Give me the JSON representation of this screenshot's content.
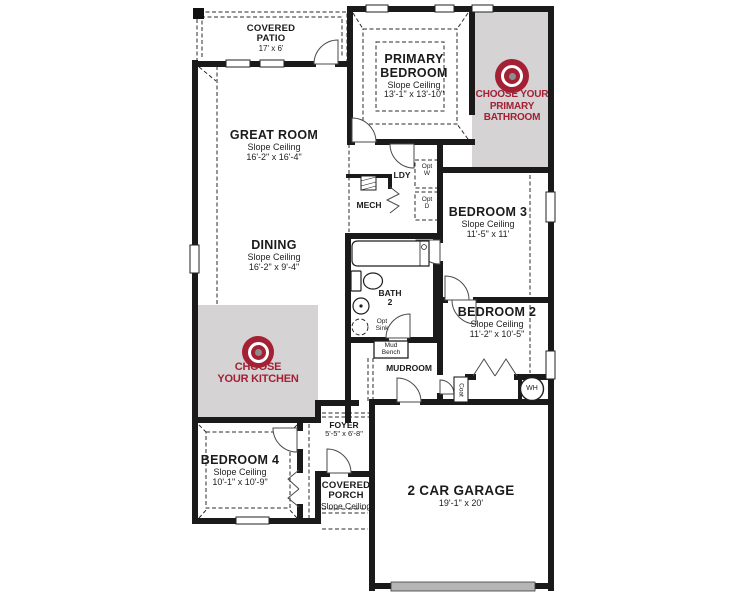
{
  "title": "Floor Plan",
  "colors": {
    "accent_red": "#A32035",
    "room_fill_gray": "#D5D3D3",
    "wall_black": "#1A1A1A",
    "garage_door_gray": "#B5B5B5"
  },
  "rooms": {
    "covered_patio": {
      "line1": "COVERED",
      "line2": "PATIO",
      "dims": "17' x 6'"
    },
    "primary_bedroom": {
      "line1": "PRIMARY",
      "line2": "BEDROOM",
      "sub": "Slope Ceiling",
      "dims": "13'-1\" x 13'-10\""
    },
    "great_room": {
      "line1": "GREAT ROOM",
      "sub": "Slope Ceiling",
      "dims": "16'-2\" x 16'-4\""
    },
    "dining": {
      "line1": "DINING",
      "sub": "Slope Ceiling",
      "dims": "16'-2\" x 9'-4\""
    },
    "bedroom_3": {
      "line1": "BEDROOM 3",
      "sub": "Slope Ceiling",
      "dims": "11'-5\" x 11'"
    },
    "bedroom_2": {
      "line1": "BEDROOM 2",
      "sub": "Slope Ceiling",
      "dims": "11'-2\" x 10'-5\""
    },
    "bedroom_4": {
      "line1": "BEDROOM 4",
      "sub": "Slope Ceiling",
      "dims": "10'-1\" x 10'-9\""
    },
    "foyer": {
      "line1": "FOYER",
      "dims": "5'-5\" x 6'-8\""
    },
    "covered_porch": {
      "line1": "COVERED",
      "line2": "PORCH",
      "sub": "Slope Ceiling"
    },
    "garage": {
      "line1": "2 CAR GARAGE",
      "dims": "19'-1\" x 20'"
    },
    "mech": {
      "line1": "MECH"
    },
    "laundry": {
      "line1": "LDY"
    },
    "bath_2": {
      "line1": "BATH",
      "line2": "2"
    },
    "mudroom": {
      "line1": "MUDROOM"
    }
  },
  "fixtures": {
    "opt_washer": {
      "line1": "Opt",
      "line2": "W"
    },
    "opt_dryer": {
      "line1": "Opt",
      "line2": "D"
    },
    "opt_sink": {
      "line1": "Opt",
      "line2": "Sink"
    },
    "mud_bench": {
      "line1": "Mud",
      "line2": "Bench"
    },
    "coat_closet": {
      "line1": "Coat"
    },
    "water_heater": {
      "line1": "WH"
    }
  },
  "badges": {
    "kitchen": {
      "line1": "CHOOSE",
      "line2": "YOUR KITCHEN"
    },
    "primary_bathroom": {
      "line1": "CHOOSE YOUR",
      "line2": "PRIMARY",
      "line3": "BATHROOM"
    }
  }
}
